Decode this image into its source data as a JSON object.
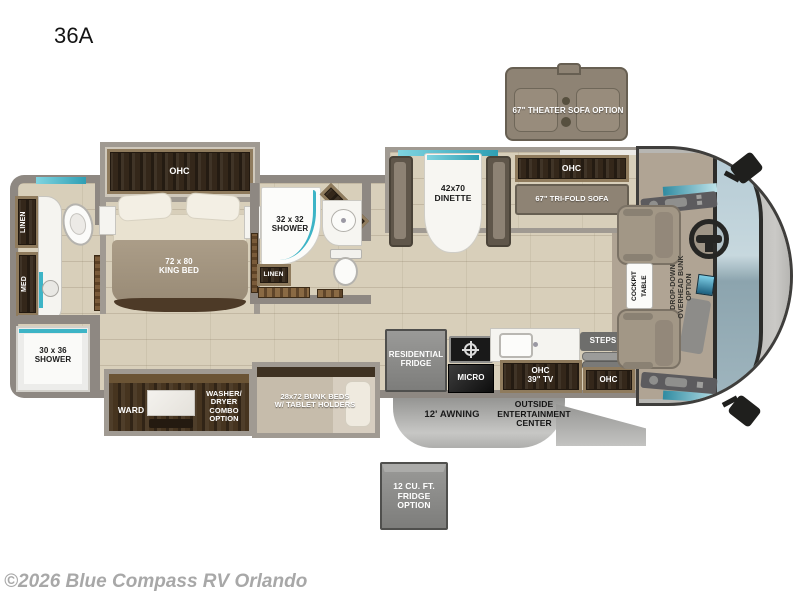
{
  "meta": {
    "model": "36A",
    "watermark": "©2026 Blue Compass RV Orlando"
  },
  "colors": {
    "accent_teal": "#3db4c6",
    "wood_dark": "#34271a",
    "wood_frame": "#8f7b5d",
    "sofa_taupe": "#8e8374",
    "wall_gray": "#8e8882",
    "floor_beige": "#d8cfba",
    "option_gray": "#8d8d8b",
    "windshield_blue": "#a9c3ce"
  },
  "bedroom": {
    "ohc": "OHC",
    "king_bed": "72 x 80\nKING BED"
  },
  "rear_bath": {
    "linen": "LINEN",
    "med": "MED",
    "shower": "30 x 36\nSHOWER"
  },
  "mid_bath": {
    "shower": "32 x 32\nSHOWER",
    "med": "MED",
    "linen": "LINEN"
  },
  "bottom_slide": {
    "ward": "WARD",
    "washer_dryer": "WASHER/\nDRYER\nCOMBO\nOPTION",
    "bunk_beds": "28x72 BUNK BEDS\nW/ TABLET HOLDERS"
  },
  "living": {
    "dinette": "42x70\nDINETTE",
    "ohc": "OHC",
    "tri_fold_sofa": "67\" TRI-FOLD SOFA",
    "theater_sofa": "67\" THEATER SOFA OPTION"
  },
  "kitchen": {
    "fridge": "RESIDENTIAL\nFRIDGE",
    "micro": "MICRO",
    "ohc_tv": "OHC\n39\" TV",
    "steps": "STEPS",
    "ohc": "OHC"
  },
  "exterior": {
    "entertainment": "OUTSIDE\nENTERTAINMENT\nCENTER",
    "awning": "12' AWNING",
    "fridge_option": "12 CU. FT.\nFRIDGE\nOPTION"
  },
  "cockpit": {
    "table": "COCKPIT\nTABLE",
    "overhead_bunk": "DROP-DOWN\nOVERHEAD BUNK\nOPTION"
  }
}
